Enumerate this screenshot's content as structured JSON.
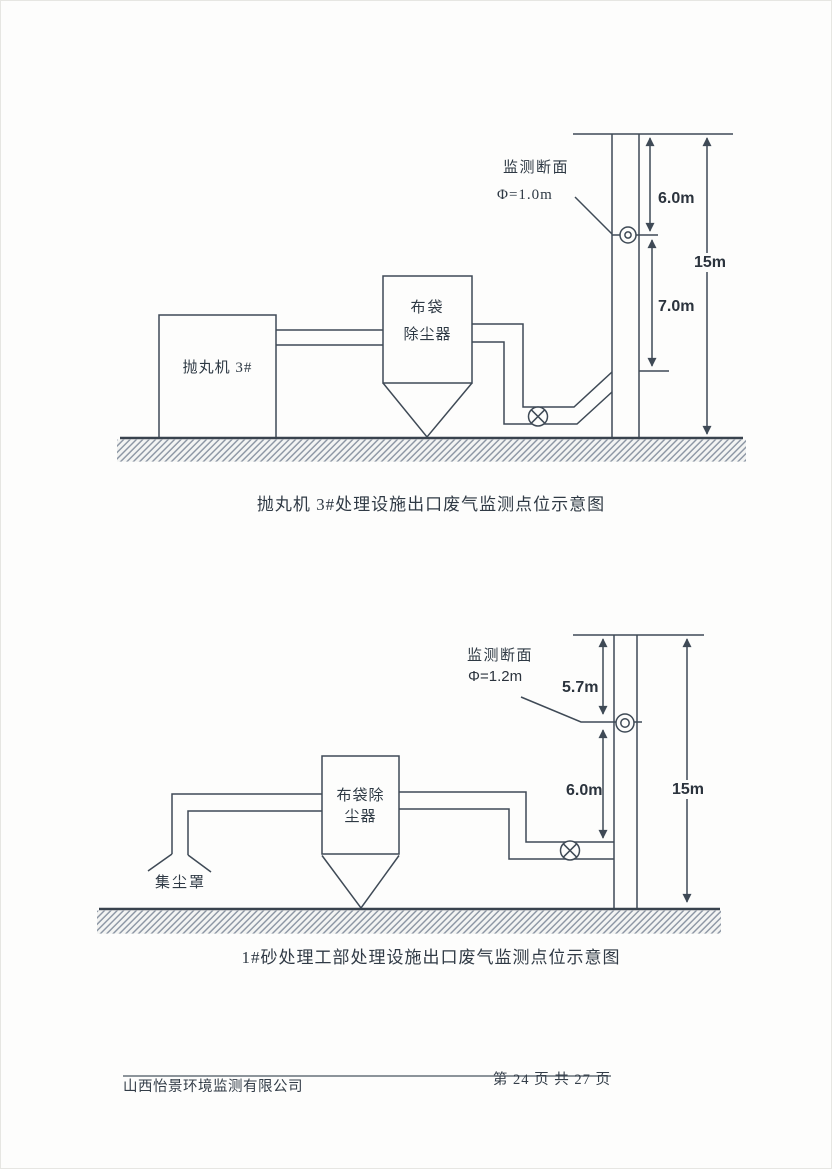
{
  "colors": {
    "ink": "#3f4a56",
    "ground": "#39434e",
    "hatch": "#8a94a2",
    "text": "#2e3944"
  },
  "diagram1": {
    "caption": "抛丸机 3#处理设施出口废气监测点位示意图",
    "labels": {
      "machine": "抛丸机 3#",
      "collector_line1": "布袋",
      "collector_line2": "除尘器",
      "monitor_line1": "监测断面",
      "monitor_line2": "Φ=1.0m",
      "dim_top": "6.0m",
      "dim_mid": "7.0m",
      "dim_total": "15m"
    }
  },
  "diagram2": {
    "caption": "1#砂处理工部处理设施出口废气监测点位示意图",
    "labels": {
      "hood": "集尘罩",
      "collector_line1": "布袋除",
      "collector_line2": "尘器",
      "monitor_line1": "监测断面",
      "monitor_line2": "Φ=1.2m",
      "dim_top": "5.7m",
      "dim_mid": "6.0m",
      "dim_total": "15m"
    }
  },
  "footer": {
    "company": "山西怡景环境监测有限公司",
    "page_info": "第 24 页 共 27 页"
  }
}
